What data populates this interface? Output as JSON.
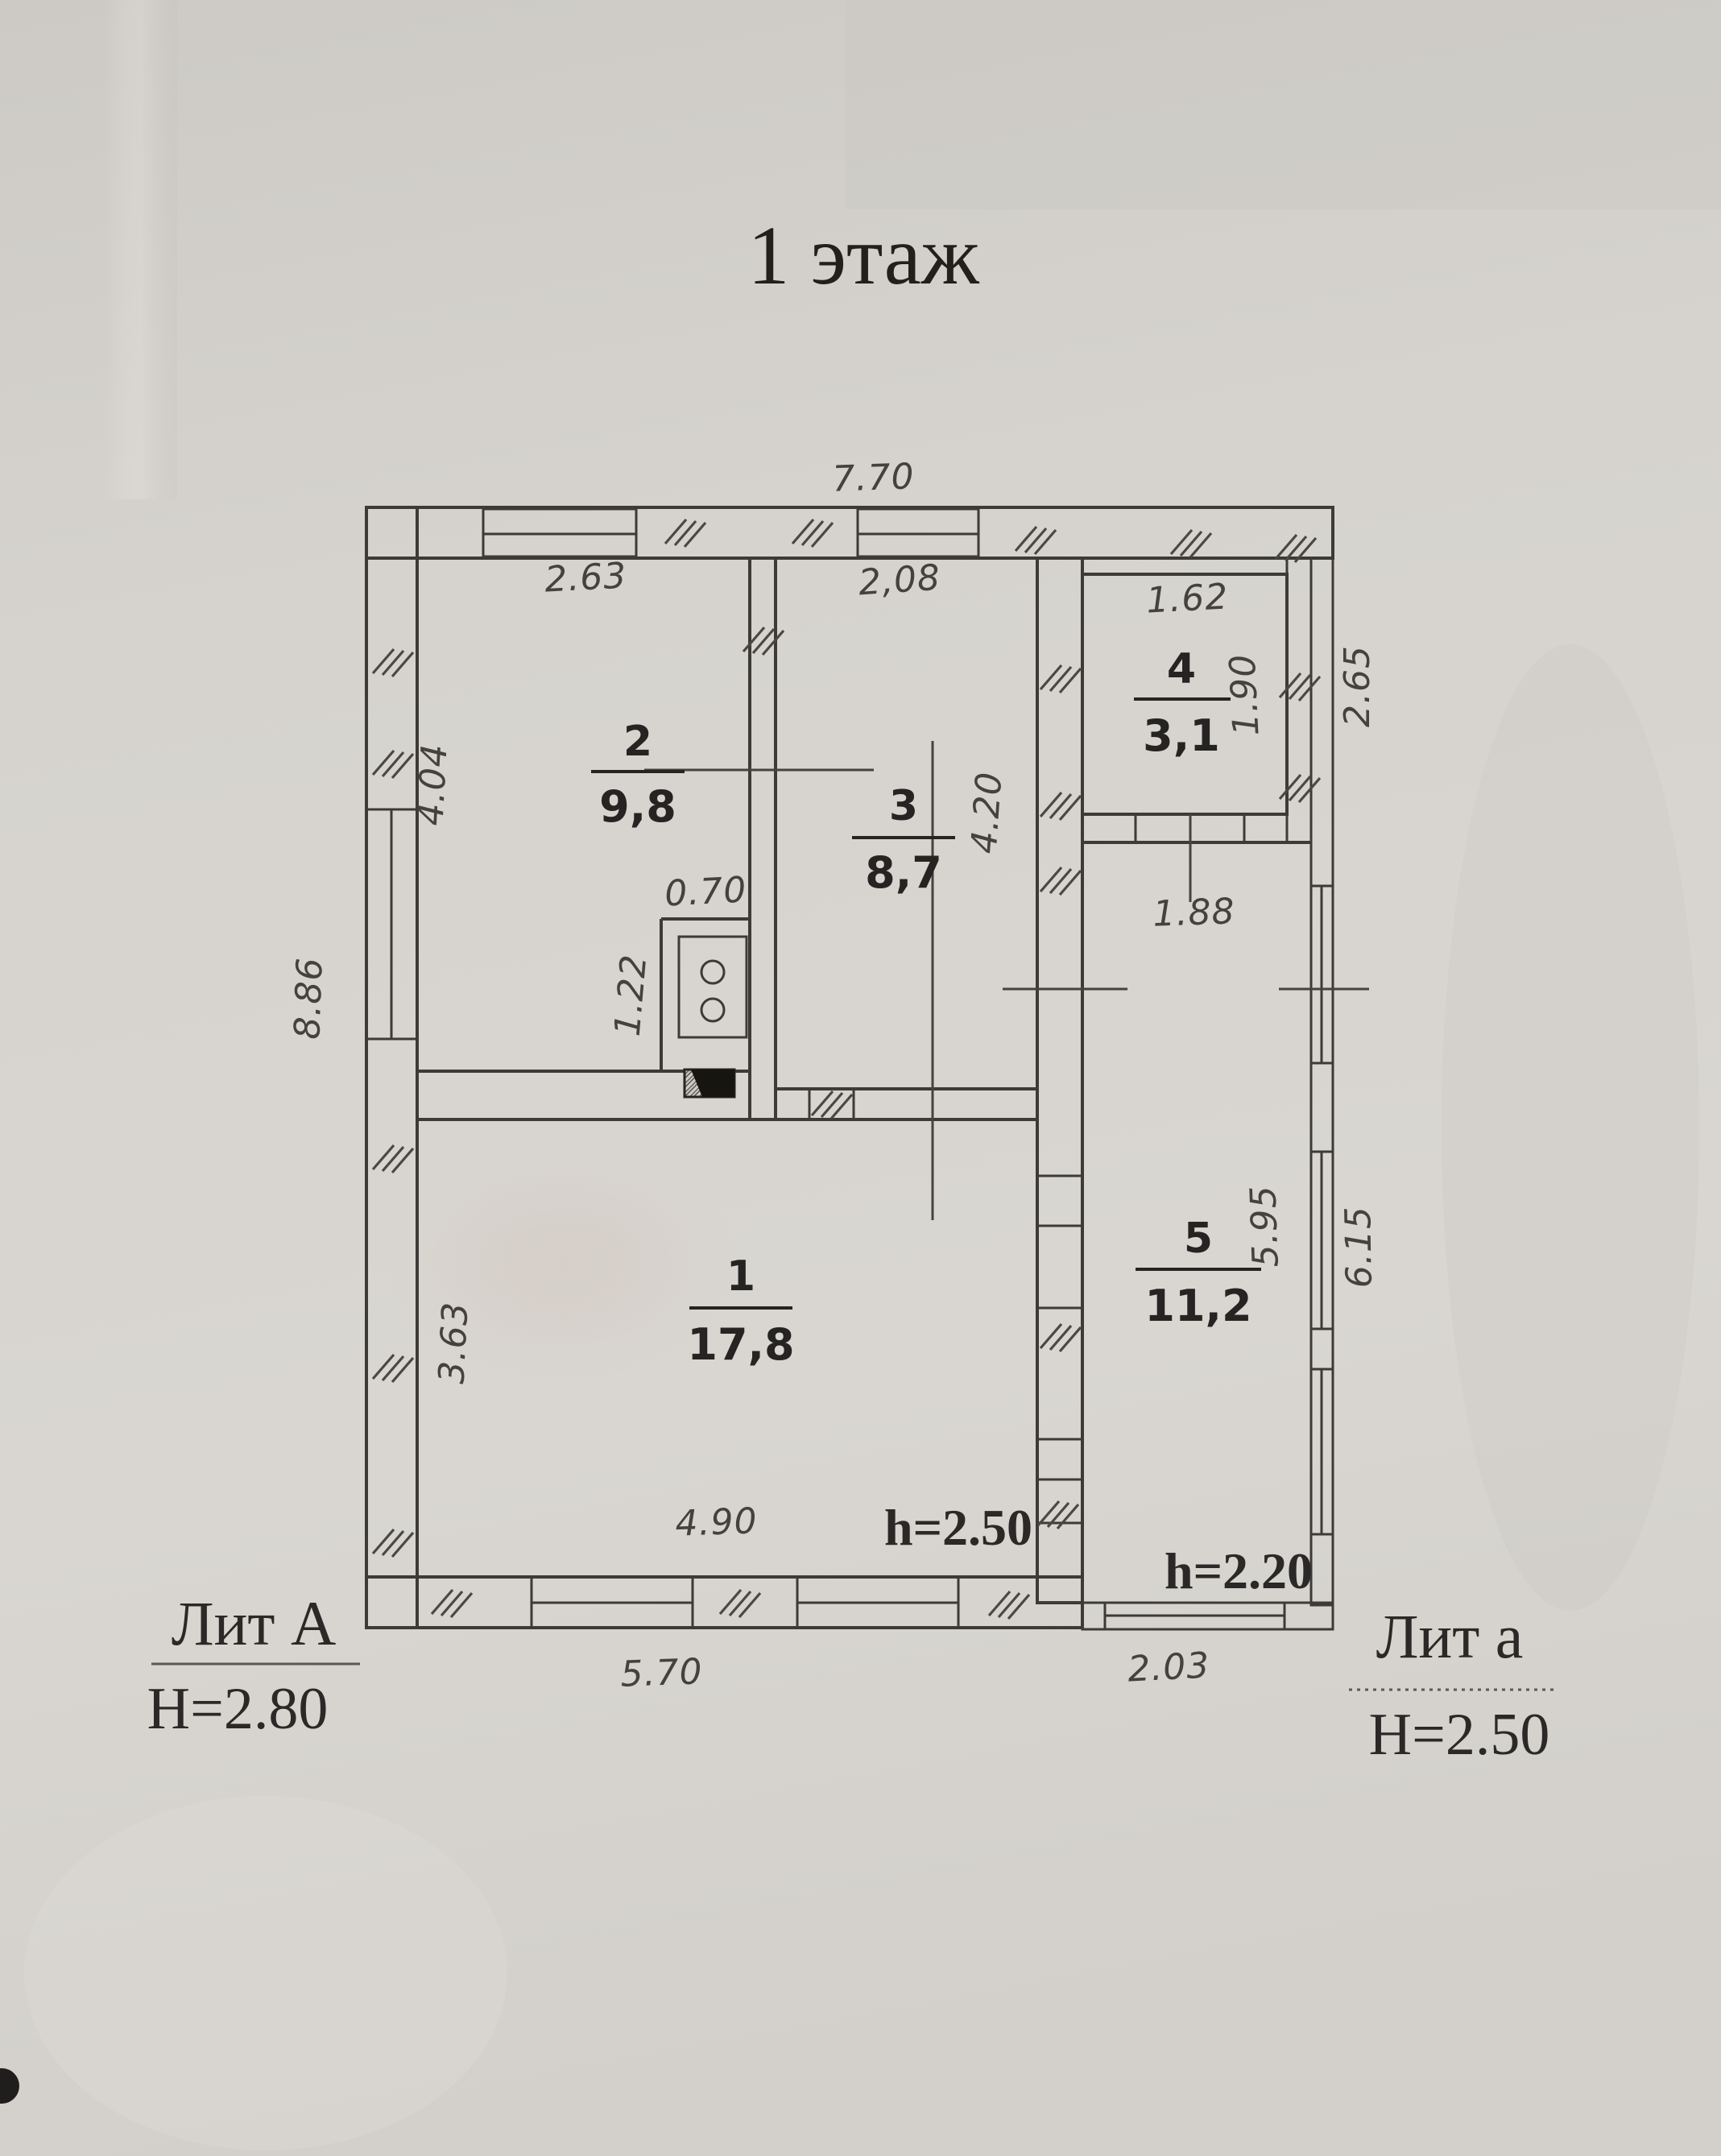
{
  "document": {
    "type": "scanned-floor-plan",
    "title": "1 этаж"
  },
  "plan": {
    "rooms": [
      {
        "number": "1",
        "area": "17,8"
      },
      {
        "number": "2",
        "area": "9,8"
      },
      {
        "number": "3",
        "area": "8,7"
      },
      {
        "number": "4",
        "area": "3,1"
      },
      {
        "number": "5",
        "area": "11,2"
      }
    ],
    "dims": {
      "top_width": "7.70",
      "room2_width": "2.63",
      "room3_width": "2,08",
      "room4_width": "1.62",
      "room4_height": "1.90",
      "annex_top_height": "2.65",
      "room2_height": "4.04",
      "room3_height": "4.20",
      "left_total_height": "8.86",
      "stove_nook_width": "0.70",
      "stove_nook_depth": "1.22",
      "room5_width": "1.88",
      "room5_height": "5.95",
      "annex_right_height": "6.15",
      "room1_height": "3.63",
      "room1_width": "4.90",
      "bottom_main_width": "5.70",
      "bottom_annex_width": "2.03"
    },
    "ceiling_heights": {
      "room1": "h=2.50",
      "room5": "h=2.20"
    },
    "legend": {
      "main_building": {
        "label": "Лит А",
        "height": "Н=2.80"
      },
      "annex": {
        "label": "Лит а",
        "height": "Н=2.50"
      }
    },
    "symbols": {
      "stove": "two-burner-stove",
      "flue": "chimney-flue"
    }
  },
  "colors": {
    "paper": "#d6d3ce",
    "line": "#3d3a37",
    "ink": "#2b2927"
  }
}
